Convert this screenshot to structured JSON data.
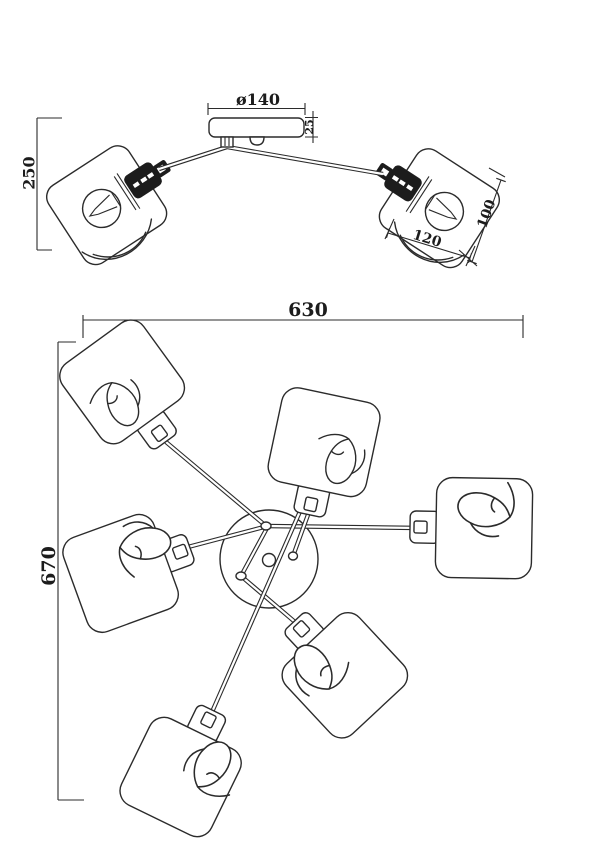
{
  "drawing": {
    "colors": {
      "line": "#2b2b2b",
      "background": "#ffffff"
    },
    "side_view": {
      "dims": {
        "canopy_diameter": "ø140",
        "canopy_height": "25",
        "fixture_height": "250",
        "shade_depth": "100",
        "shade_width": "120"
      }
    },
    "top_view": {
      "dims": {
        "overall_width": "630",
        "overall_depth": "670"
      }
    }
  }
}
